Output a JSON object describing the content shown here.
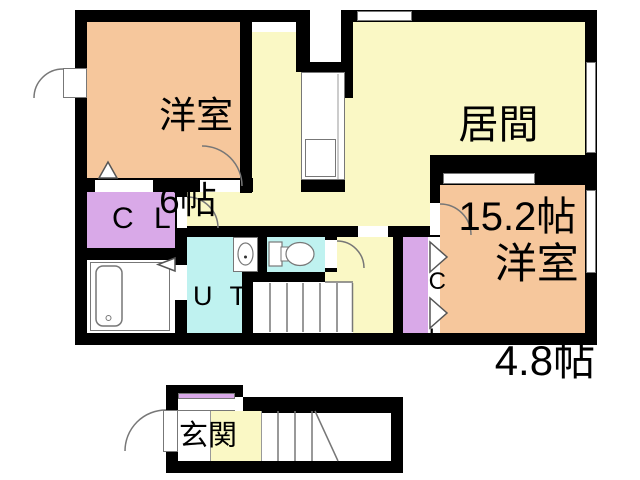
{
  "title": "間取り図",
  "colors": {
    "orange": "#f6c79c",
    "yellow": "#faf8c5",
    "purple": "#d9a9e8",
    "cyan": "#bff2f0",
    "wall": "#000000"
  },
  "upper_floor": {
    "bedroom1": {
      "name": "洋室",
      "size": "6帖"
    },
    "living": {
      "name": "居間",
      "size": "15.2帖"
    },
    "bedroom2": {
      "name": "洋室",
      "size": "4.8帖"
    },
    "closet_left": {
      "label": "C L"
    },
    "utility": {
      "label": "U T"
    },
    "closet_right": {
      "line1": "C",
      "line2": "L"
    }
  },
  "ground_floor": {
    "entrance": {
      "name": "玄関"
    }
  }
}
